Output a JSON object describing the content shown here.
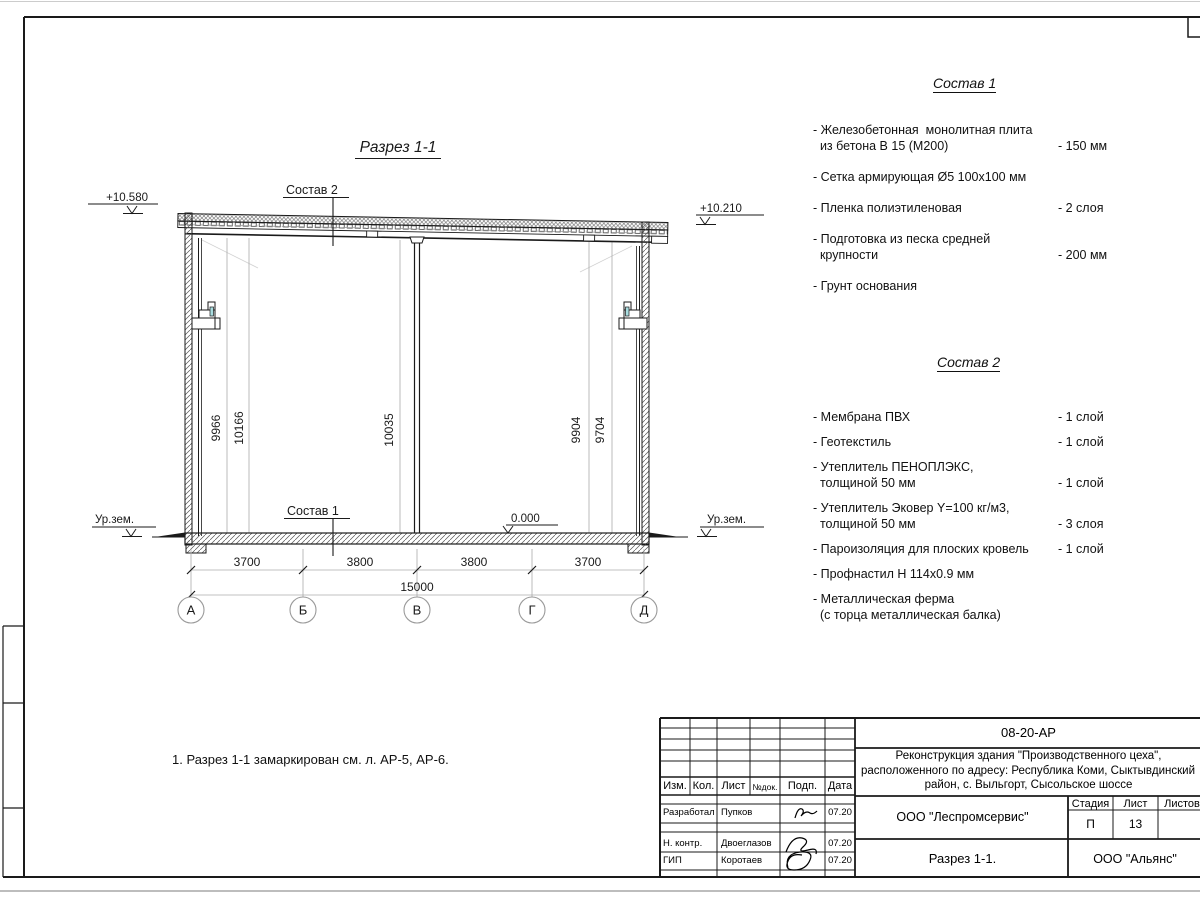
{
  "drawing": {
    "title": "Разрез 1-1",
    "labels": {
      "sostav2_ref": "Состав 2",
      "sostav1_ref": "Состав 1"
    },
    "elevations": {
      "roof_left": "+10.580",
      "roof_right": "+10.210",
      "floor": "0.000",
      "ground_left": "Ур.зем.",
      "ground_right": "Ур.зем."
    },
    "vertical_dims": [
      "9966",
      "10166",
      "10035",
      "9904",
      "9704"
    ],
    "horizontal_dims": [
      "3700",
      "3800",
      "3800",
      "3700"
    ],
    "total_dim": "15000",
    "axes": [
      "А",
      "Б",
      "В",
      "Г",
      "Д"
    ]
  },
  "sostav1": {
    "title": "Состав 1",
    "items": [
      {
        "name": "- Железобетонная  монолитная плита\n  из бетона В 15 (М200)",
        "value": "- 150 мм"
      },
      {
        "name": "- Сетка армирующая Ø5 100х100 мм",
        "value": ""
      },
      {
        "name": "- Пленка полиэтиленовая",
        "value": "-  2 слоя"
      },
      {
        "name": "- Подготовка из песка средней\n  крупности",
        "value": "- 200 мм"
      },
      {
        "name": "- Грунт основания",
        "value": ""
      }
    ]
  },
  "sostav2": {
    "title": "Состав 2",
    "items": [
      {
        "name": "- Мембрана ПВХ",
        "value": "- 1 слой"
      },
      {
        "name": "- Геотекстиль",
        "value": "- 1 слой"
      },
      {
        "name": "- Утеплитель ПЕНОПЛЭКС,\n  толщиной 50 мм",
        "value": "- 1 слой"
      },
      {
        "name": "- Утеплитель Эковер Y=100 кг/м3,\n  толщиной 50 мм",
        "value": "- 3 слоя"
      },
      {
        "name": "- Пароизоляция для плоских кровель",
        "value": "- 1 слой"
      },
      {
        "name": "- Профнастил Н 114х0.9 мм",
        "value": ""
      },
      {
        "name": "- Металлическая ферма\n  (с торца металлическая балка)",
        "value": ""
      }
    ]
  },
  "note": "1. Разрез 1-1 замаркирован см. л. АР-5, АР-6.",
  "titleblock": {
    "doc_number": "08-20-АР",
    "project_line1": "Реконструкция здания \"Производственного цеха\",",
    "project_line2": "расположенного по адресу: Республика Коми, Сыктывдинский",
    "project_line3": "район, с. Выльгорт, Сысольское шоссе",
    "header": {
      "izm": "Изм.",
      "kol": "Кол.",
      "list": "Лист",
      "ndoc": "№док.",
      "podp": "Подп.",
      "data": "Дата"
    },
    "rows": [
      {
        "role": "Разработал",
        "name": "Пупков",
        "date": "07.20"
      },
      {
        "role": "Н. контр.",
        "name": "Двоеглазов",
        "date": "07.20"
      },
      {
        "role": "ГИП",
        "name": "Коротаев",
        "date": "07.20"
      }
    ],
    "org": "ООО \"Леспромсервис\"",
    "stage_label": "Стадия",
    "sheet_label": "Лист",
    "sheets_label": "Листов",
    "stage": "П",
    "sheet": "13",
    "sheet_title": "Разрез 1-1.",
    "client": "ООО \"Альянс\""
  },
  "colors": {
    "line": "#1a1a1a",
    "dim": "#9a9a9a",
    "faint_dim_text": "#b5b5b5",
    "teal_detail": "#a9dde0"
  }
}
